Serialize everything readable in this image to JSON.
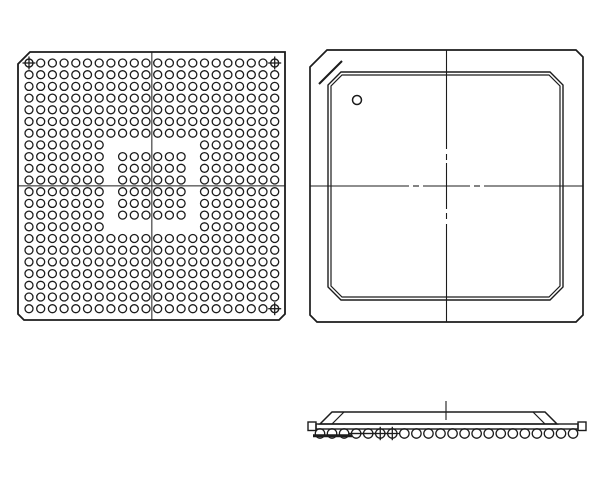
{
  "canvas": {
    "width": 600,
    "height": 500,
    "background": "#ffffff",
    "line_color": "#1c1c1c"
  },
  "bottom_view": {
    "outline": {
      "x1": 18,
      "y1": 52,
      "x2": 285,
      "y2": 320,
      "chamfer_a1_corner": 12,
      "chamfer_other": 6
    },
    "ball_grid": {
      "rows": 22,
      "cols": 22,
      "origin_x": 29,
      "origin_y": 63,
      "pitch": 11.7,
      "ball_radius": 4.0
    },
    "depopulated_ring": {
      "rows": [
        8,
        15
      ],
      "cols": [
        8,
        15
      ]
    },
    "center_island": {
      "rows": [
        9,
        14
      ],
      "cols": [
        9,
        14
      ]
    },
    "total_balls": 456,
    "fiducial_positions": [
      {
        "row": 1,
        "col": 1
      },
      {
        "row": 1,
        "col": 22
      },
      {
        "row": 22,
        "col": 22
      }
    ],
    "centerline": {
      "x": 151.85,
      "y": 185.85
    }
  },
  "top_view": {
    "outline": {
      "x1": 310,
      "y1": 50,
      "x2": 583,
      "y2": 322,
      "chamfer_a1_corner": 17,
      "chamfer_other": 7
    },
    "a1_band_line": {
      "x1": 342,
      "y1": 61,
      "x2": 319,
      "y2": 84
    },
    "mold_cap": {
      "x1": 328,
      "y1": 72,
      "x2": 563,
      "y2": 300,
      "chamfer": 13,
      "inner_offset": 3
    },
    "pin1_circle": {
      "cx": 357,
      "cy": 100,
      "r": 4.5
    },
    "centerline_v": {
      "x": 446.5,
      "segments": [
        [
          50,
          149
        ],
        [
          154,
          160
        ],
        [
          163,
          209
        ],
        [
          213,
          219
        ],
        [
          224,
          322
        ]
      ]
    },
    "centerline_h": {
      "y": 186,
      "segments": [
        [
          310,
          409
        ],
        [
          413,
          419
        ],
        [
          423,
          470
        ],
        [
          474,
          480
        ],
        [
          484,
          583
        ]
      ]
    }
  },
  "side_view": {
    "center_tick": {
      "x": 446,
      "y1": 401,
      "y2": 420
    },
    "mold_profile": {
      "top_x1": 332,
      "top_x2": 545,
      "top_y": 412,
      "base_x1": 320,
      "base_x2": 557,
      "base_y": 424,
      "inner_offset": 12
    },
    "substrate": {
      "x1": 316,
      "y1": 424,
      "x2": 578,
      "y2": 429
    },
    "end_caps": [
      {
        "x": 308,
        "y": 422,
        "w": 8,
        "h": 8.5
      },
      {
        "x": 578,
        "y": 422,
        "w": 8,
        "h": 8.5
      }
    ],
    "balls": {
      "count": 22,
      "start_x": 320,
      "pitch": 12.05,
      "cy": 433.5,
      "r": 4.7
    },
    "seating_plane_mark": {
      "x1": 313,
      "x2": 352,
      "y": 435.8
    },
    "slash_marked_balls": [
      4,
      5
    ],
    "cross_marked_balls": [
      6,
      7
    ]
  }
}
